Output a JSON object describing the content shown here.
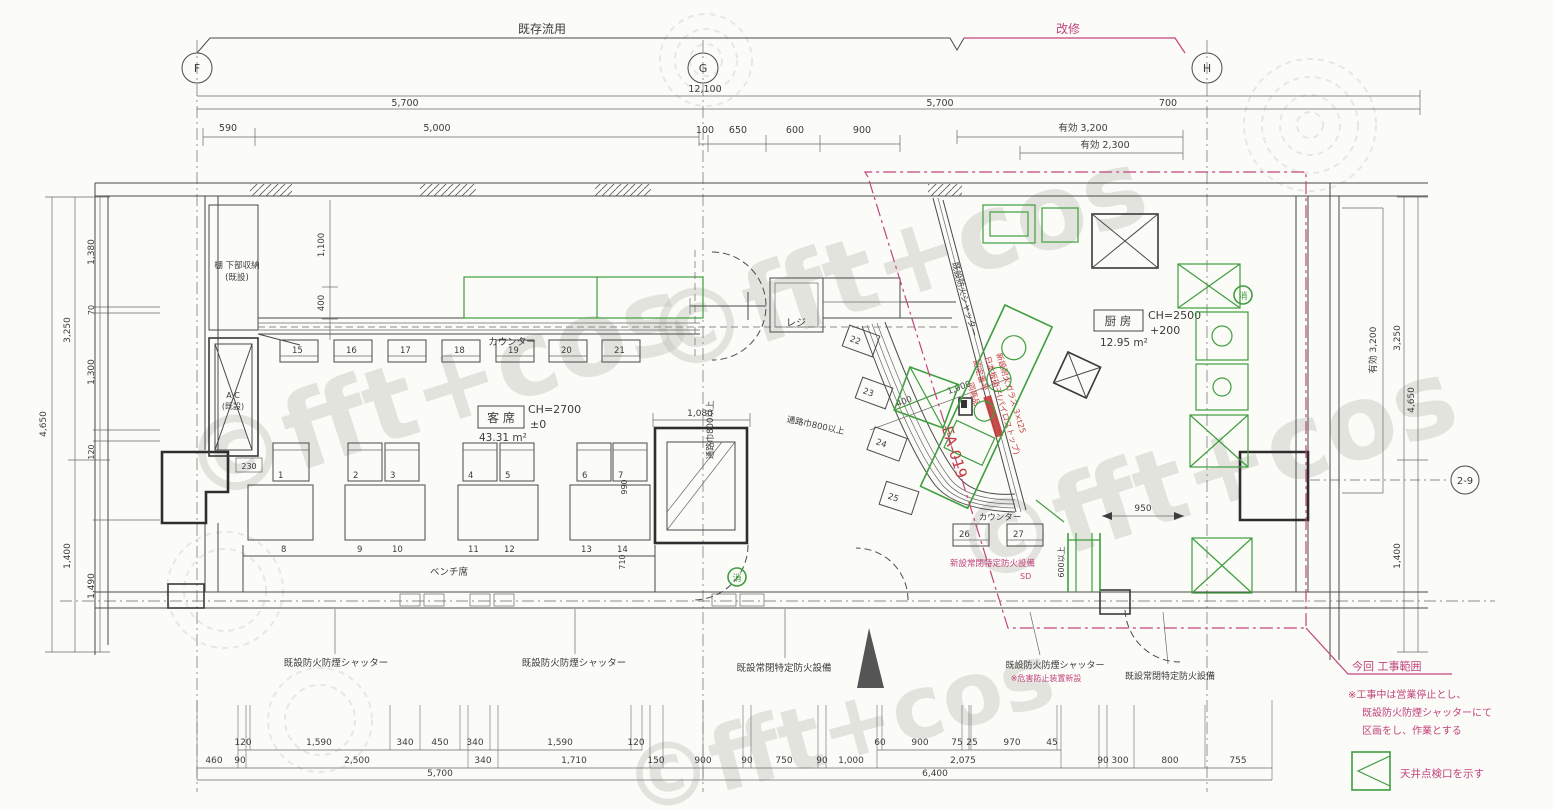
{
  "colors": {
    "green": "#3f9e3f",
    "pink": "#c2447c",
    "red": "#c23a3a",
    "ink": "#3c3c3c",
    "paper": "#fbfbf8"
  },
  "header": {
    "existing_bracket": "既存流用",
    "renovation_bracket": "改修",
    "grid_f": "F",
    "grid_g": "G",
    "grid_h": "H",
    "grid_29": "2-9"
  },
  "dims_top": {
    "total": "12,100",
    "span_fg": "5,700",
    "span_gh": "5,700",
    "span_right": "700",
    "d590": "590",
    "d5000": "5,000",
    "d100": "100",
    "d650": "650",
    "d600": "600",
    "d900": "900",
    "yuko_3200": "有効 3,200",
    "yuko_2300": "有効 2,300"
  },
  "dims_left": {
    "d4650": "4,650",
    "d3250": "3,250",
    "d1400": "1,400",
    "d1380": "1,380",
    "d70": "70",
    "d1300": "1,300",
    "d120": "120",
    "d1490": "1,490"
  },
  "dims_right": {
    "yuko_3200": "有効 3,200",
    "d3250": "3,250",
    "d4650": "4,650",
    "d1400": "1,400"
  },
  "dims_bottom": {
    "upper_left": [
      "120",
      "1,590",
      "340",
      "450",
      "340",
      "1,590",
      "120"
    ],
    "upper_right": [
      "60",
      "900",
      "75",
      "25",
      "970",
      "45"
    ],
    "mid": [
      "460",
      "90",
      "2,500",
      "340",
      "1,710",
      "150",
      "900",
      "90",
      "750",
      "90",
      "1,000",
      "2,075",
      "90",
      "300",
      "800",
      "755"
    ],
    "total_left": "5,700",
    "total_right": "6,400"
  },
  "dims_inner": {
    "d1100": "1,100",
    "d400": "400",
    "d230": "230",
    "d990": "990",
    "d710": "710",
    "d1080": "1,080",
    "aisle1": "通路巾800以上",
    "aisle2": "通路巾800以上",
    "d400b": "400",
    "d1000": "1,000",
    "d950": "950",
    "d600over": "600以上"
  },
  "rooms": {
    "seating_name": "客 席",
    "seating_ch": "CH=2700",
    "seating_level": "±0",
    "seating_area": "43.31 m²",
    "kitchen_name": "厨 房",
    "kitchen_ch": "CH=2500",
    "kitchen_level": "+200",
    "kitchen_area": "12.95 m²"
  },
  "labels": {
    "counter1": "カウンター",
    "counter2": "カウンター",
    "register": "レジ",
    "shelf1": "棚 下部収納",
    "shelf2": "(既設)",
    "ac1": "A C",
    "ac2": "(既設)",
    "bench": "ベンチ席",
    "fire_mark": "消"
  },
  "seats": {
    "stools": [
      "15",
      "16",
      "17",
      "18",
      "19",
      "20",
      "21"
    ],
    "chairs": [
      "1",
      "2",
      "3",
      "4",
      "5",
      "6",
      "7"
    ],
    "bench": [
      "8",
      "9",
      "10",
      "11",
      "12",
      "13",
      "14"
    ],
    "counter": [
      "22",
      "23",
      "24",
      "25",
      "26",
      "27"
    ]
  },
  "notes_black": {
    "shutter1": "既設防火防煙シャッター",
    "shutter2": "既設防火防煙シャッター",
    "firedoor1": "既設常閉特定防火設備",
    "shutter3": "既設防火防煙シャッター",
    "firedoor2": "既設常閉特定防火設備",
    "shutter_diag": "既設防火シャッター"
  },
  "notes_pink": {
    "new_firedoor": "新設常閉特定防火設備",
    "new_firedoor_sd": "SD",
    "hazard_note": "※危害防止装置新設",
    "scope_title": "今回 工事範囲",
    "scope_note1": "※工事中は営業停止とし、",
    "scope_note2": "既設防火防煙シャッターにて",
    "scope_note3": "区画をし、作業とする"
  },
  "notes_red": {
    "glass1": "新設耐火ガラス 3×t25",
    "glass2": "日本板硝子(パイロストップ)",
    "glass3": "認定番号",
    "glass4": "同等品",
    "code": "EA-019"
  },
  "legend": {
    "text": "天井点検口を示す"
  },
  "watermark": {
    "text": "©fft+cos"
  }
}
